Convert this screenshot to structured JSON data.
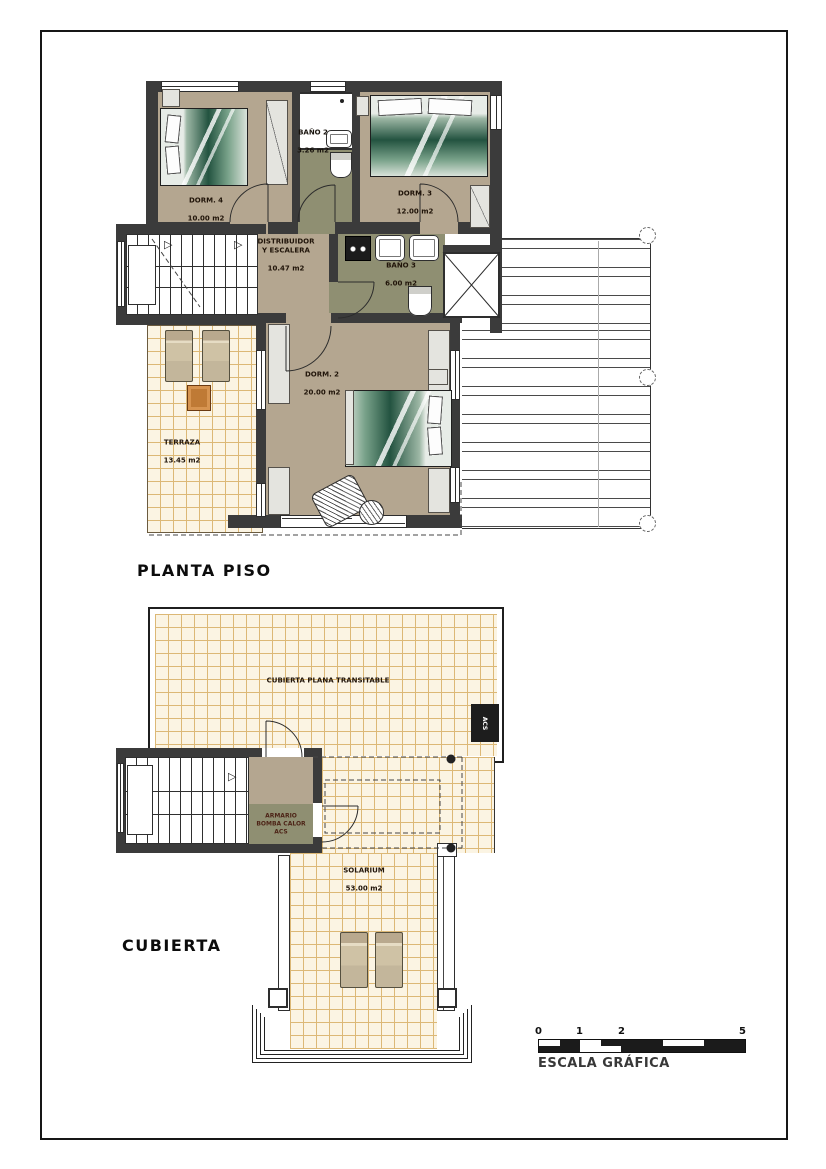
{
  "titles": {
    "planta": "PLANTA PISO",
    "cubierta": "CUBIERTA"
  },
  "scale": {
    "label": "ESCALA GRÁFICA",
    "ticks": [
      "0",
      "1",
      "2",
      "5"
    ]
  },
  "planta_piso": {
    "rooms": {
      "dorm4": {
        "name": "DORM. 4",
        "area": "10.00 m2"
      },
      "bano2": {
        "name": "BAÑO 2",
        "area": "3.26 m2"
      },
      "dorm3": {
        "name": "DORM. 3",
        "area": "12.00 m2"
      },
      "distribuidor": {
        "name": "DISTRIBUIDOR\nY ESCALERA",
        "area": "10.47 m2"
      },
      "bano3": {
        "name": "BAÑO 3",
        "area": "6.00 m2"
      },
      "dorm2": {
        "name": "DORM. 2",
        "area": "20.00 m2"
      },
      "terraza": {
        "name": "TERRAZA",
        "area": "13.45 m2"
      }
    }
  },
  "cubierta": {
    "labels": {
      "roof": "CUBIERTA PLANA TRANSITABLE",
      "armario": "ARMARIO\nBOMBA CALOR\nACS",
      "acs_box": "ACS",
      "solarium": {
        "name": "SOLARIUM",
        "area": "53.00 m2"
      }
    }
  },
  "colors": {
    "wall": "#3b3b3b",
    "room_floor": "#b4a690",
    "bath_floor": "#8f8f72",
    "tile_bg": "#fbf4e3",
    "tile_line": "#dcb876",
    "bed_green": "#235340",
    "table_orange": "#bf7a35"
  }
}
